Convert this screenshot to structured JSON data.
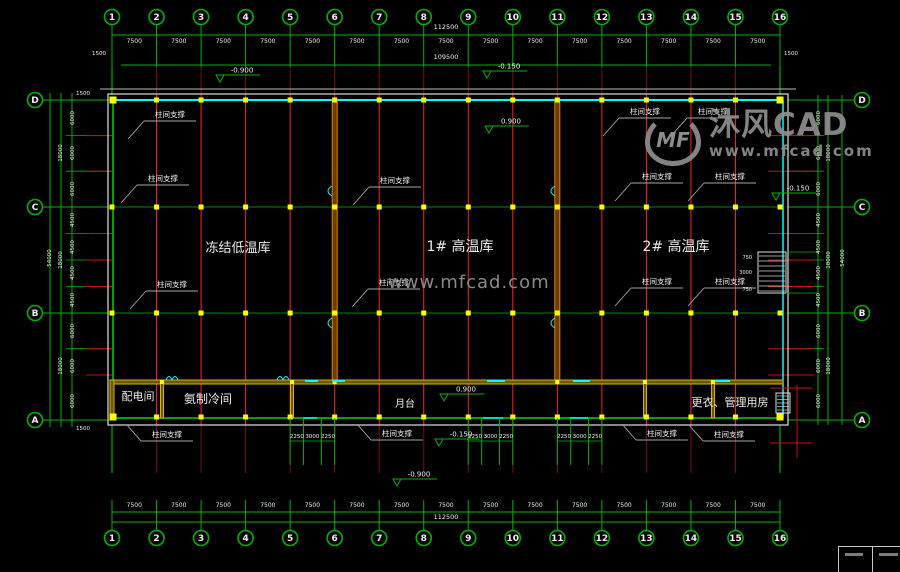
{
  "watermark": {
    "logo_mf": "MF",
    "logo_text": "沐风CAD",
    "logo_url": "www.mfcad.com",
    "center_url": "www.mfcad.com"
  },
  "grid": {
    "column_labels": [
      "1",
      "2",
      "3",
      "4",
      "5",
      "6",
      "7",
      "8",
      "9",
      "10",
      "11",
      "12",
      "13",
      "14",
      "15",
      "16"
    ],
    "row_labels": [
      "D",
      "C",
      "B",
      "A"
    ]
  },
  "dimensions": {
    "top": {
      "bay": "7500",
      "total": "112500",
      "inner_total": "109500",
      "end_offset": "1500"
    },
    "bottom": {
      "bay": "7500",
      "total": "112500"
    },
    "side": {
      "sub": [
        "6000",
        "6000",
        "6000",
        "4500",
        "4500",
        "4500",
        "4500",
        "6000",
        "6000",
        "6000"
      ],
      "spans": [
        "18000",
        "18000",
        "18000"
      ],
      "total": "54000",
      "offset_top": "1500",
      "offset_bottom": "1500"
    },
    "platform_steps": [
      "2250",
      "3000",
      "2250"
    ],
    "dock_steps": [
      "750",
      "3000",
      "750"
    ]
  },
  "rooms": [
    {
      "name": "冻结低温库"
    },
    {
      "name": "1# 高温库"
    },
    {
      "name": "2# 高温库"
    },
    {
      "name": "配电间"
    },
    {
      "name": "氨制冷间"
    },
    {
      "name": "月台"
    },
    {
      "name": "更衣、管理用房"
    }
  ],
  "bracing_label": "柱间支撑",
  "elevations": [
    {
      "value": "-0.900"
    },
    {
      "value": "-0.150"
    },
    {
      "value": "0.900"
    },
    {
      "value": "0.900"
    },
    {
      "value": "-0.150"
    },
    {
      "value": "-0.900"
    },
    {
      "value": "-0.150"
    }
  ],
  "colors": {
    "background": "#000000",
    "dim_green": "#00b400",
    "bright_green": "#00d800",
    "red": "#ff2222",
    "dark_red": "#7a1010",
    "cyan": "#00ffff",
    "yellow": "#ffff00",
    "wall_yellow": "#d8b400",
    "wall_orange": "#e08000",
    "outline_white": "#dedede",
    "leader_gray": "#a8a8a8",
    "text_white": "#f0f0f0",
    "watermark_gray": "#8f8f8f"
  }
}
